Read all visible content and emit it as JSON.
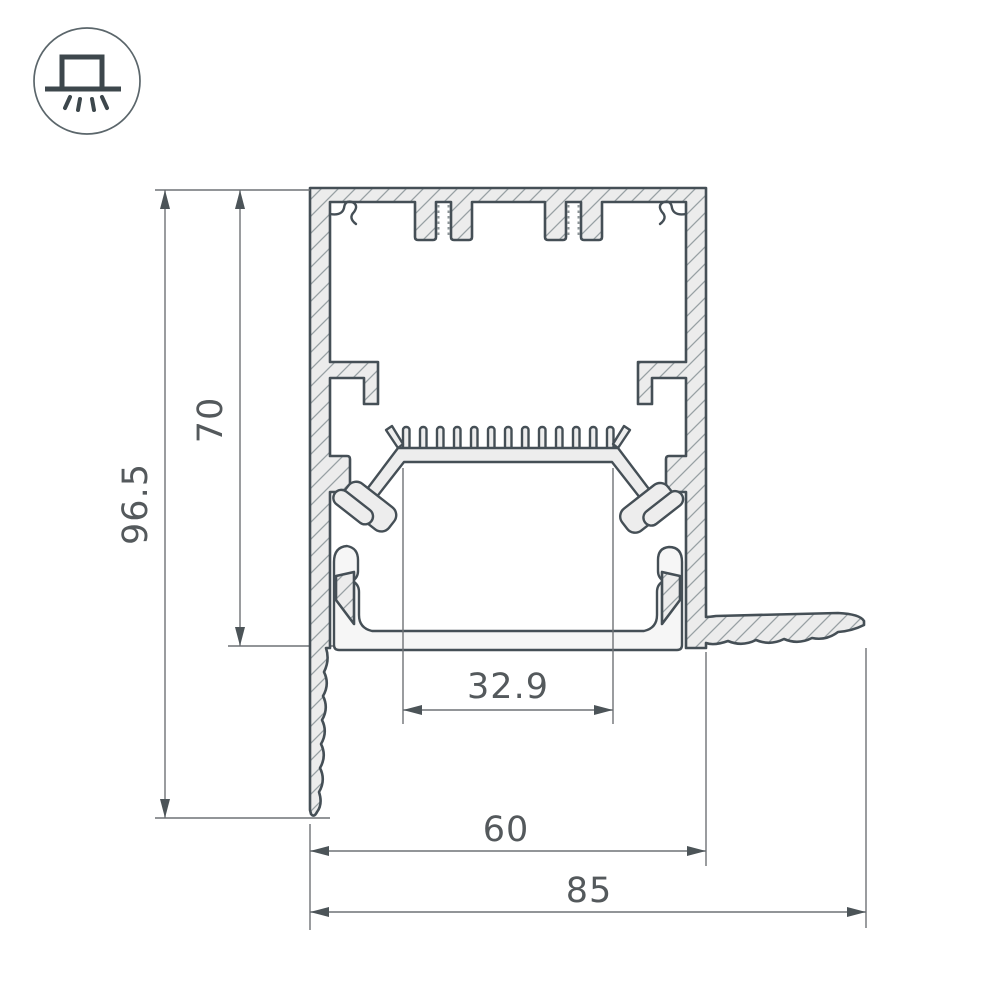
{
  "page": {
    "background": "#ffffff",
    "kind": "technical drawing"
  },
  "icon": {
    "name": "surface-mounted-luminaire-icon",
    "description": "luminaire on ceiling line with downward light rays inside a circle"
  },
  "drawing": {
    "subject": "aluminium LED profile cross-section with dimensions",
    "dimensions": {
      "overall_height": "96.5",
      "inner_height": "70",
      "inner_width": "32.9",
      "body_width": "60",
      "overall_width": "85"
    },
    "colors": {
      "outline": "#454f56",
      "fill": "#ececec",
      "hatch": "#97a0a3",
      "dimension_line": "#6f7276",
      "text": "#54595c"
    }
  }
}
